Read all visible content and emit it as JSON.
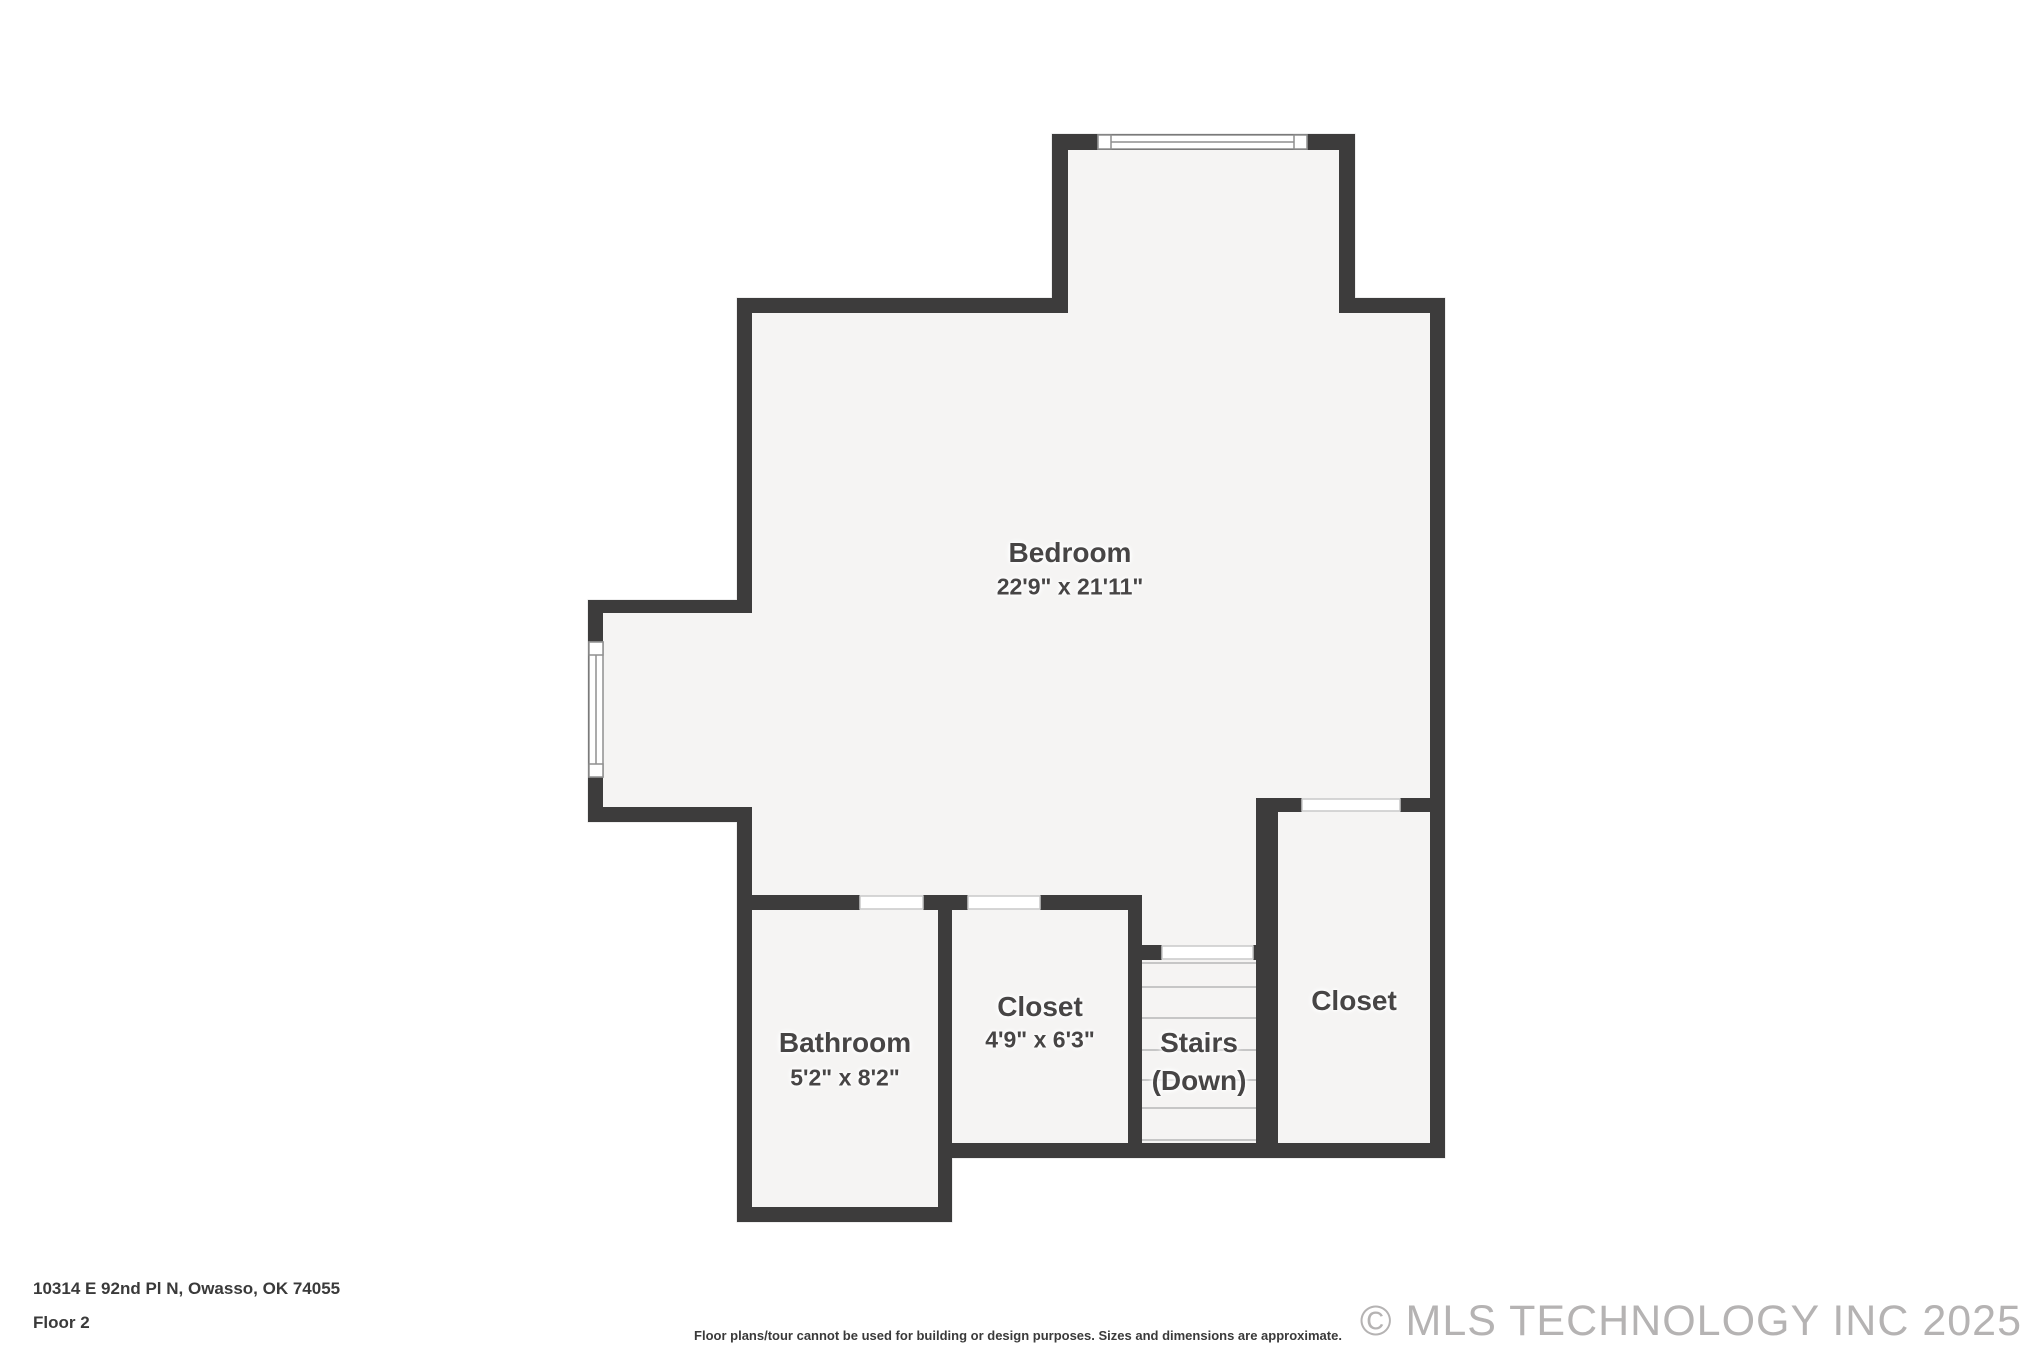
{
  "colors": {
    "wall": "#3d3c3c",
    "floor": "#f5f4f3",
    "background": "#ffffff",
    "label_text": "#474545",
    "tread_line": "#c6c6c6",
    "door_opening": "#ffffff",
    "window_border": "#8f8f8f",
    "footer_text": "#3a3a3a",
    "copyright_text": "#b5b3b3"
  },
  "rooms": {
    "bedroom": {
      "name": "Bedroom",
      "dims": "22'9\" x 21'11\""
    },
    "bathroom": {
      "name": "Bathroom",
      "dims": "5'2\" x 8'2\""
    },
    "closet_middle": {
      "name": "Closet",
      "dims": "4'9\" x 6'3\""
    },
    "stairs": {
      "name": "Stairs",
      "sub": "(Down)"
    },
    "closet_right": {
      "name": "Closet"
    }
  },
  "footer": {
    "address": "10314 E 92nd Pl N, Owasso, OK 74055",
    "floor_label": "Floor 2",
    "disclaimer": "Floor plans/tour cannot be used for building or design purposes. Sizes and dimensions are approximate.",
    "copyright": "© MLS TECHNOLOGY INC 2025"
  }
}
